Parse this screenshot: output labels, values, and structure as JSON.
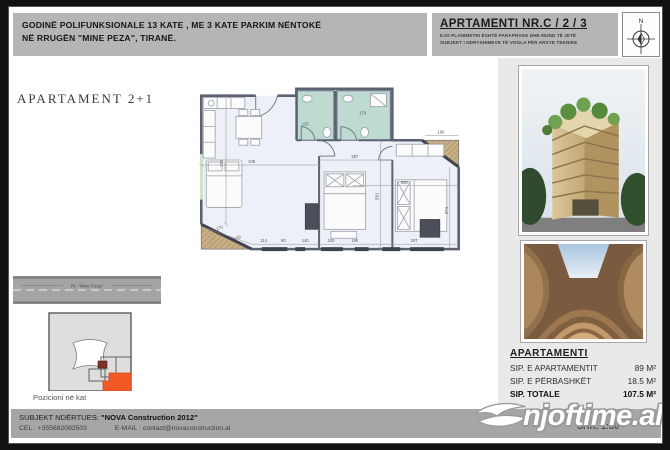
{
  "header": {
    "project_title_line1": "GODINË POLIFUNKSIONALE 13 KATE , ME 3 KATE PARKIM NËNTOKË",
    "project_title_line2": "NË RRUGËN \"MINE PEZA\", TIRANË.",
    "apartment_title": "APRTAMENTI NR.C / 2 / 3",
    "disclaimer_line1": "KJO PLANIMETRI ËSHTË PARAPRAKE DHE MUND TË JETË",
    "disclaimer_line2": "SUBJEKT I NDRYSHIMEVE TË VOGLA PËR ARSYE TEKNIKE",
    "compass_north_label": "N"
  },
  "plan": {
    "label": "APARTAMENT 2+1",
    "dimensions": [
      "725",
      "348",
      "357",
      "500",
      "530",
      "274",
      "160",
      "120",
      "170",
      "170",
      "150",
      "114",
      "80",
      "140",
      "100",
      "190",
      "297"
    ]
  },
  "position_diagram": {
    "road_label": "Rr. \"Mine Peza\"",
    "caption": "Pozicioni në kat"
  },
  "area_table": {
    "title": "APARTAMENTI",
    "rows": [
      {
        "label": "SIP. E APARTAMENTIT",
        "value": "89 M²"
      },
      {
        "label": "SIP. E PËRBASHKËT",
        "value": "18.5 M²"
      },
      {
        "label": "SIP. TOTALE",
        "value": "107.5 M²"
      }
    ]
  },
  "footer": {
    "builder_label": "SUBJEKT NDËRTUES:",
    "builder_name": "\"NOVA Construction 2012\"",
    "phone": "CEL : +355692082503",
    "email": "E-MAIL : contact@novaconstruction.al",
    "scale": "SHK. 1:80"
  },
  "watermark": {
    "text": "njoftime.al"
  },
  "colors": {
    "accent_orange": "#f15a24",
    "header_gray": "#b5b5b5",
    "bathroom_teal": "#bedbd2",
    "balcony_tan": "#c8ae84",
    "panel_gray": "#e9e9e9"
  }
}
